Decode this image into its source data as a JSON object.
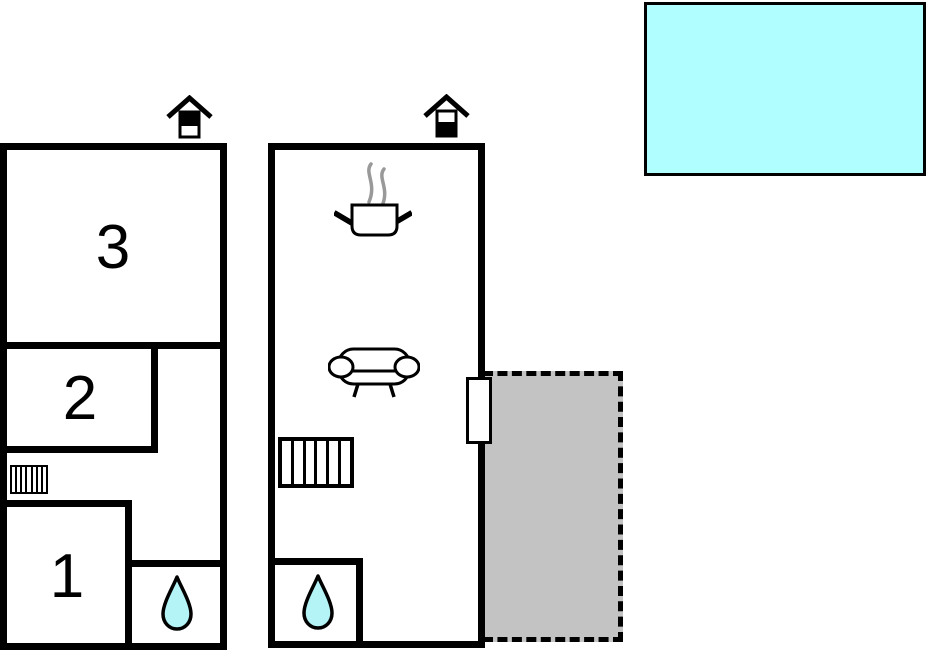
{
  "title": "two-unit holiday house floor plan",
  "colors": {
    "wall": "#000000",
    "background": "#ffffff",
    "pool": "#b0feff",
    "water": "#b4f4f6",
    "terrace": "#c3c3c3",
    "steam": "#999999"
  },
  "units": {
    "left": {
      "marker": "house-icon",
      "room_labels": [
        "3",
        "2",
        "1"
      ],
      "features": [
        "radiator-icon",
        "water-drop-icon"
      ]
    },
    "right": {
      "marker": "house-icon",
      "features": [
        "cooking-pot-icon",
        "steam-icon",
        "sofa-icon",
        "stairs-icon",
        "water-drop-icon",
        "door-opening"
      ]
    }
  },
  "outdoor": {
    "pool": "pool-area",
    "terrace": "terrace-area"
  }
}
